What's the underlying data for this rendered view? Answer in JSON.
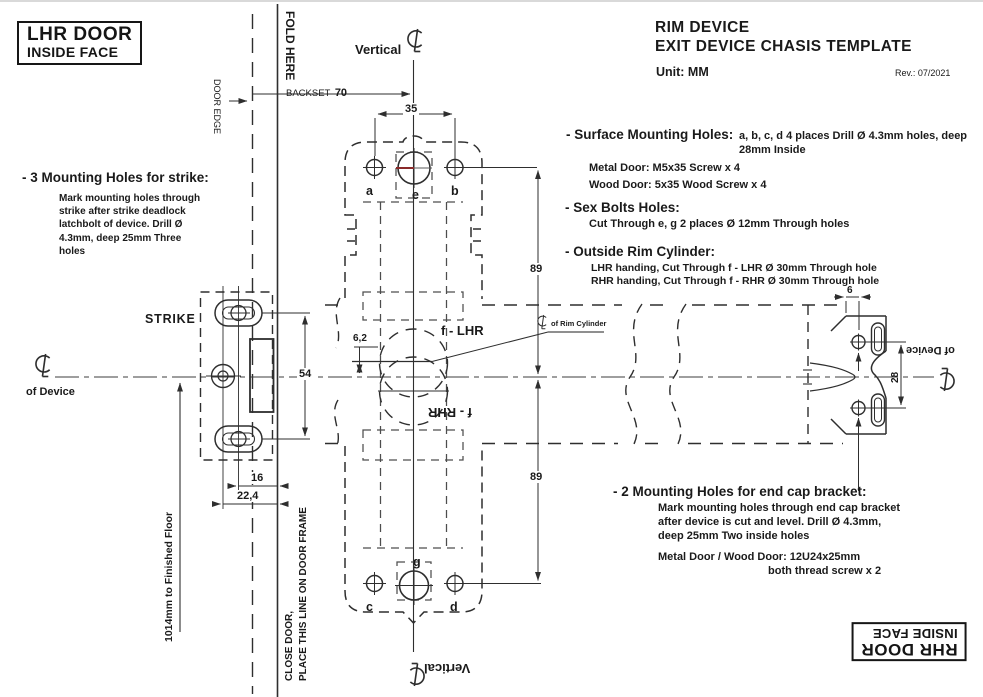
{
  "header": {
    "title_line1": "RIM DEVICE",
    "title_line2": "EXIT DEVICE CHASIS TEMPLATE",
    "unit_label": "Unit: MM",
    "revision": "Rev.: 07/2021"
  },
  "corner_boxes": {
    "top_left": {
      "line1": "LHR DOOR",
      "line2": "INSIDE FACE"
    },
    "bottom_right": {
      "line1": "RHR DOOR",
      "line2": "INSIDE FACE"
    }
  },
  "notes": {
    "strike": {
      "heading": "- 3 Mounting Holes for strike:",
      "body": "Mark mounting holes through\nstrike after strike deadlock\nlatchbolt of device. Drill  Ø\n4.3mm, deep 25mm  Three\nholes"
    },
    "surface": {
      "heading": "- Surface Mounting Holes:",
      "spec1": "a,  b,  c,  d  4 places    Drill Ø 4.3mm holes, deep",
      "spec2": "28mm  Inside",
      "metal": "Metal Door:  M5x35 Screw  x 4",
      "wood": "Wood Door:  5x35 Wood Screw  x 4"
    },
    "sex_bolts": {
      "heading": "- Sex Bolts Holes:",
      "detail": "Cut Through e, g  2 places    Ø 12mm Through holes"
    },
    "rim_cylinder": {
      "heading": "- Outside Rim Cylinder:",
      "lhr": "LHR handing, Cut Through f - LHR   Ø 30mm Through hole",
      "rhr": "RHR handing, Cut Through f - RHR   Ø 30mm Through hole"
    },
    "end_cap": {
      "heading": "- 2 Mounting Holes for end cap bracket:",
      "body": "Mark mounting holes through end cap bracket\nafter device is cut and level. Drill  Ø  4.3mm,\ndeep 25mm  Two inside holes",
      "screws1": "Metal Door / Wood Door: 12U24x25mm",
      "screws2": "both thread screw  x 2"
    }
  },
  "drawing_labels": {
    "fold_here": "FOLD HERE",
    "door_edge": "DOOR EDGE",
    "backset": "BACKSET",
    "backset_value": "70",
    "vertical_top": "Vertical",
    "vertical_bottom": "Vertical",
    "strike": "STRIKE",
    "of_device_left": "of Device",
    "of_device_right": "of Device",
    "rim_cylinder_cl": "of Rim Cylinder",
    "close_door_line1": "CLOSE DOOR,",
    "close_door_line2": "PLACE THIS LINE ON DOOR FRAME",
    "floor_note": "1014mm to Finished Floor",
    "f_lhr": "f - LHR",
    "f_rhr": "f - RHR"
  },
  "holes": {
    "a": "a",
    "b": "b",
    "c": "c",
    "d": "d",
    "e": "e",
    "g": "g"
  },
  "dimensions": {
    "d35": "35",
    "d89_top": "89",
    "d89_bottom": "89",
    "d54": "54",
    "d16": "16",
    "d22_4": "22,4",
    "d6_2": "6,2",
    "d6": "6",
    "d28": "28"
  },
  "colors": {
    "line": "#2e2e2e",
    "accent_red": "#8a2a2a",
    "background": "#ffffff"
  }
}
